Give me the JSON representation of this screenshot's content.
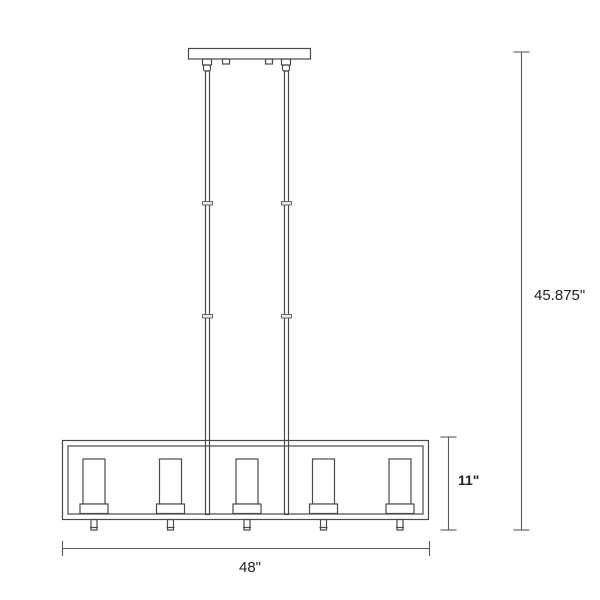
{
  "page": {
    "background_color": "#ffffff"
  },
  "diagram": {
    "kind": "product-dimension-line-drawing",
    "subject": "5-light linear chandelier with cylindrical glass shades, dual downrods and ceiling canopy",
    "light_count": 5,
    "line_color": "#4a4a4a",
    "dimension_line_color": "#5a5a5a",
    "text_color": "#222222",
    "dimensions": {
      "overall_height": {
        "label": "45.875\"",
        "measures": "canopy to bottom of frame"
      },
      "fixture_height": {
        "label": "11\"",
        "measures": "frame height"
      },
      "fixture_width": {
        "label": "48\"",
        "measures": "frame width"
      }
    }
  }
}
